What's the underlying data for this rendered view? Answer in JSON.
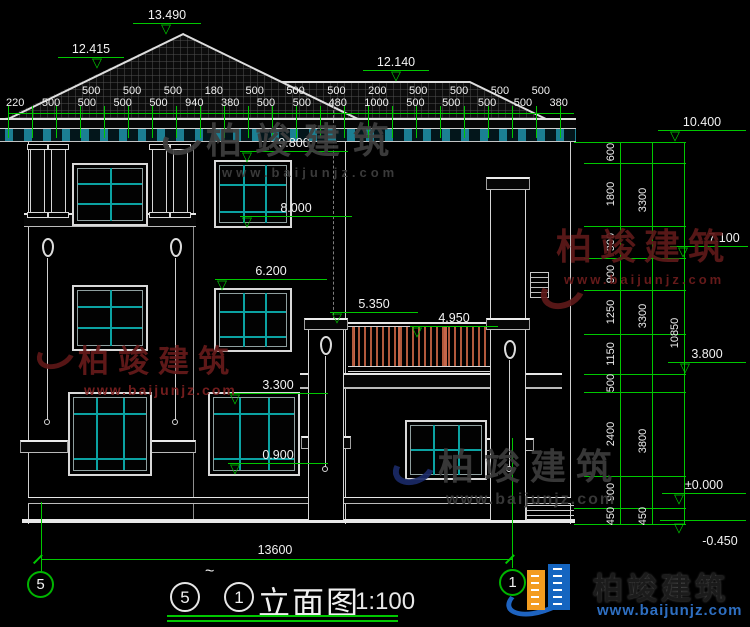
{
  "watermark": {
    "brand": "柏竣建筑",
    "url": "www.baijunjz.com"
  },
  "title_bar": {
    "grid_left": "5",
    "tilde": "~",
    "grid_right": "1",
    "name": "立面图",
    "scale": "1:100"
  },
  "grid_bubbles": {
    "left": "5",
    "right": "1"
  },
  "icons": {
    "elevation_triangle": "▽"
  },
  "elevations": {
    "roof_peak": "13.490",
    "left_eave": "12.415",
    "right_roof": "12.140",
    "right_eave": "10.400",
    "f3_window_top": "9.800",
    "f3_window_sill": "8.000",
    "f3_floor": "7.100",
    "f2_window_top": "6.200",
    "railing_top": "5.350",
    "terrace": "4.950",
    "f2_floor": "3.800",
    "f1_window_top": "3.300",
    "f1_window_sill": "0.900",
    "ground_floor": "±0.000",
    "site_ground": "-0.450"
  },
  "dimensions": {
    "top_upper_row": [
      "500",
      "500",
      "500",
      "180",
      "500",
      "500",
      "500",
      "200",
      "500",
      "500",
      "500",
      "500"
    ],
    "top_lower_row": [
      "220",
      "500",
      "500",
      "500",
      "500",
      "940",
      "380",
      "500",
      "500",
      "480",
      "1000",
      "500",
      "500",
      "500",
      "500",
      "380"
    ],
    "right_detail": [
      "600",
      "1800",
      "900",
      "900",
      "1250",
      "1150",
      "500",
      "2400",
      "900",
      "450"
    ],
    "right_floors": [
      "3300",
      "3300",
      "3800",
      "450"
    ],
    "right_total": "10850",
    "bottom_total": "13600"
  }
}
